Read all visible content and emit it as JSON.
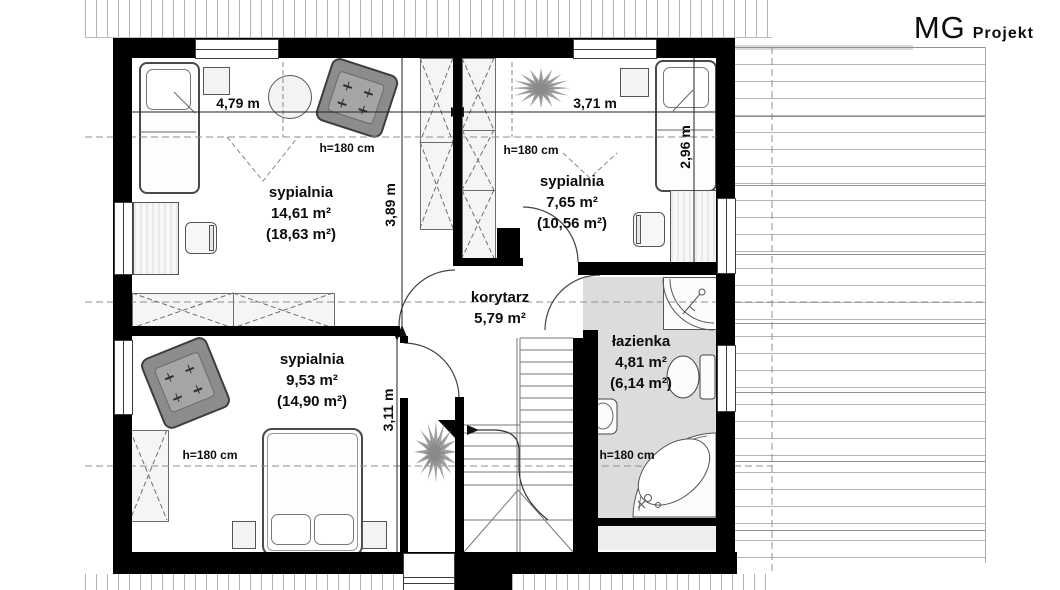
{
  "logo": {
    "brand_thin": "MG",
    "brand_bold": "Projekt"
  },
  "rooms": {
    "bedroom_top_left": {
      "name": "sypialnia",
      "area": "14,61 m²",
      "total_area": "(18,63 m²)",
      "ceiling_height": "h=180 cm"
    },
    "bedroom_top_right": {
      "name": "sypialnia",
      "area": "7,65 m²",
      "total_area": "(10,56 m²)",
      "ceiling_height": "h=180 cm"
    },
    "bedroom_bottom": {
      "name": "sypialnia",
      "area": "9,53 m²",
      "total_area": "(14,90 m²)",
      "ceiling_height": "h=180 cm"
    },
    "corridor": {
      "name": "korytarz",
      "area": "5,79 m²"
    },
    "bathroom": {
      "name": "łazienka",
      "area": "4,81 m²",
      "total_area": "(6,14 m²)",
      "ceiling_height": "h=180 cm"
    }
  },
  "dimensions": {
    "bedroom_top_left_width": "4,79 m",
    "bedroom_top_right_width": "3,71 m",
    "bedroom_top_left_depth": "3,89 m",
    "bedroom_top_right_depth": "2,96 m",
    "bedroom_bottom_depth": "3,11 m"
  },
  "colors": {
    "wall": "#000000",
    "bathroom_floor": "#dcdcdc",
    "furniture_gray": "#8c8c8c"
  }
}
